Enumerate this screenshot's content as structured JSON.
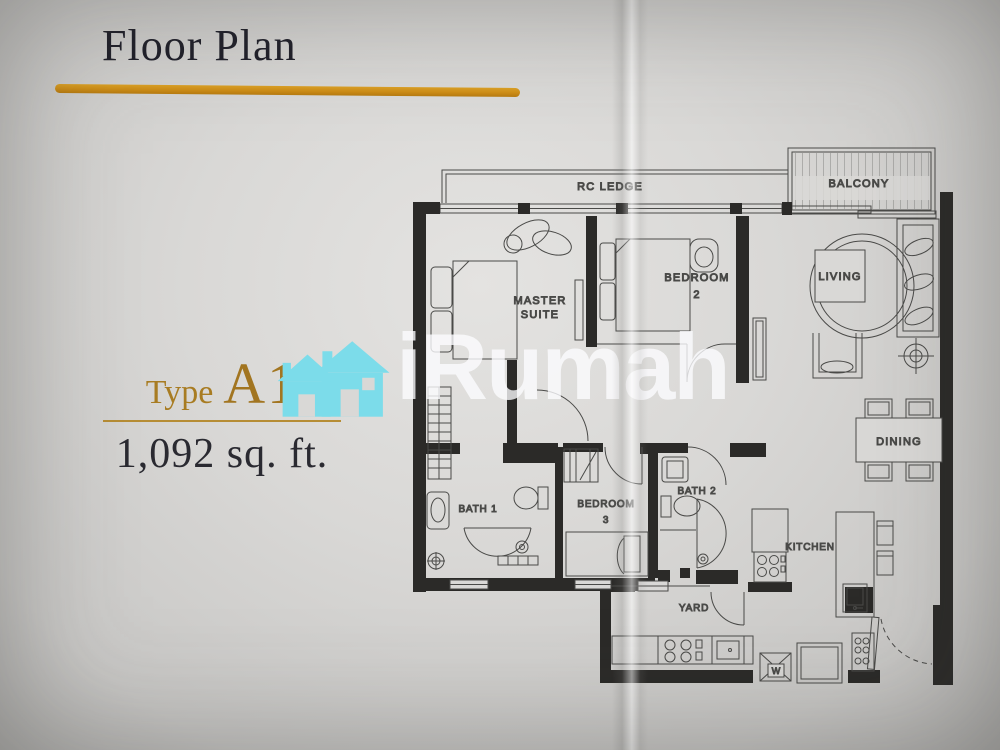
{
  "header": {
    "title": "Floor Plan"
  },
  "unit": {
    "type_label": "Type",
    "type_value": "A1",
    "area": "1,092 sq. ft."
  },
  "watermark": {
    "brand": "iRumah"
  },
  "floorplan": {
    "labels": {
      "rc_ledge": "RC LEDGE",
      "balcony": "BALCONY",
      "master_line1": "MASTER",
      "master_line2": "SUITE",
      "bedroom2_line1": "BEDROOM",
      "bedroom2_line2": "2",
      "living": "LIVING",
      "dining": "DINING",
      "bath1": "BATH 1",
      "bedroom3_line1": "BEDROOM",
      "bedroom3_line2": "3",
      "bath2": "BATH 2",
      "kitchen": "KITCHEN",
      "yard": "YARD",
      "washer": "W"
    }
  },
  "colors": {
    "accent_gold": "#c98f1e",
    "watermark_cyan": "#7cdcea",
    "page_background": "#d9d8d6",
    "wall_black": "#2b2a28"
  }
}
